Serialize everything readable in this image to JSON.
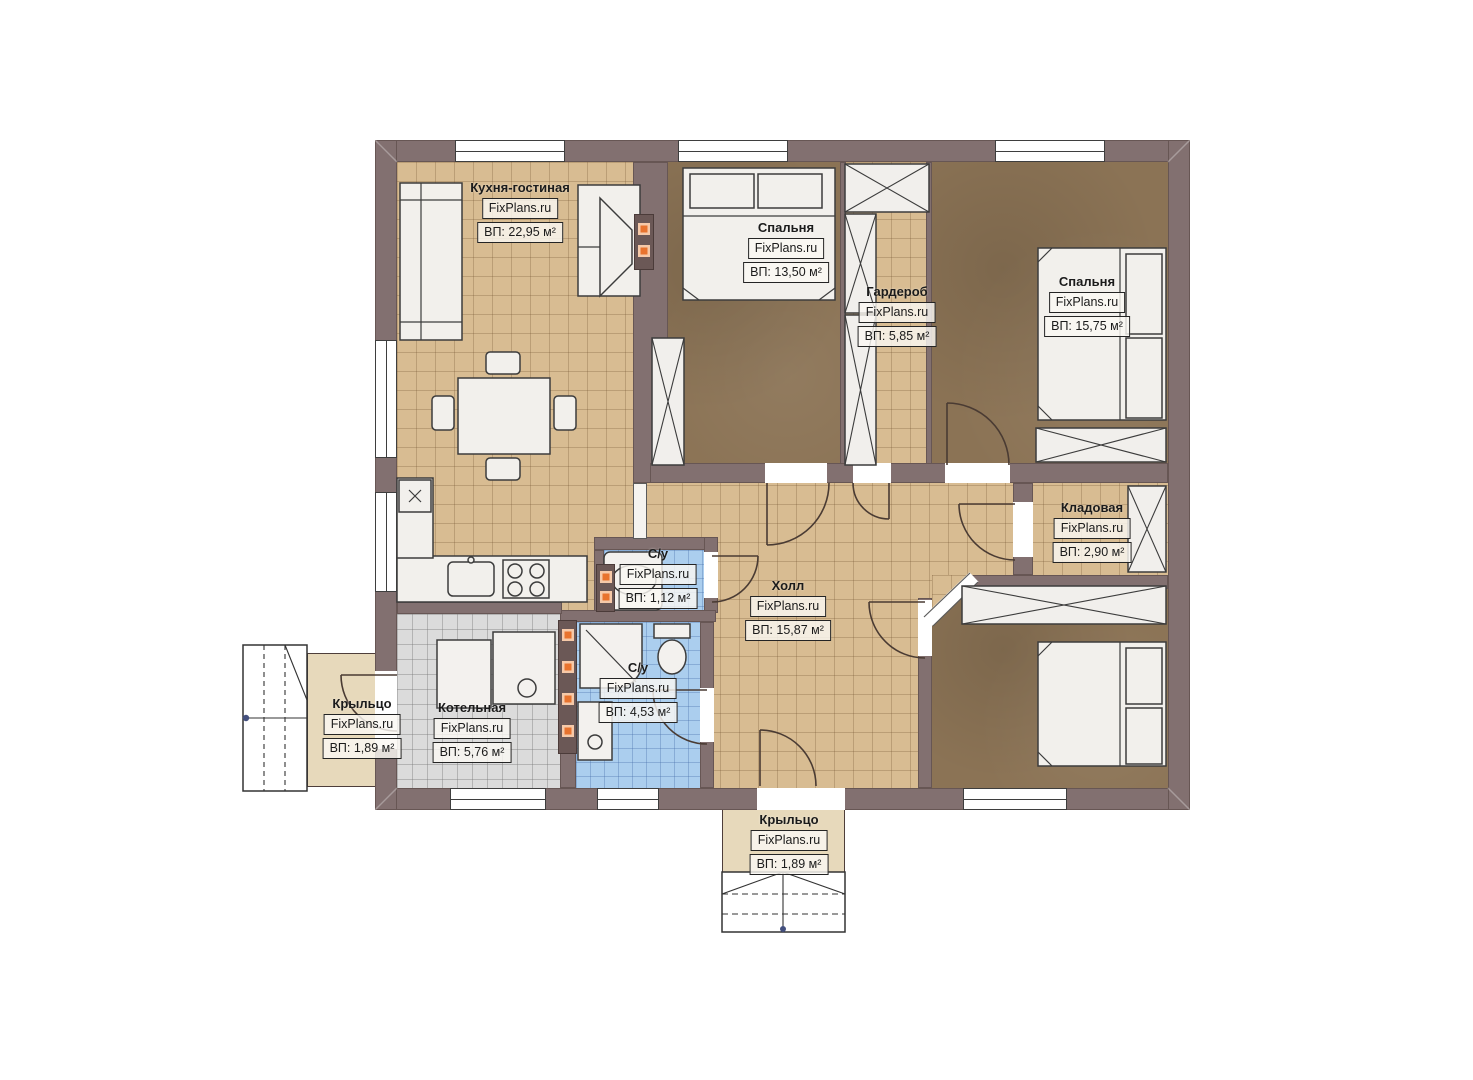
{
  "plan": {
    "title": "Floor plan of a single-storey house",
    "rooms": {
      "kitchen": {
        "name": "Кухня-гостиная",
        "brand": "FixPlans.ru",
        "area": "ВП: 22,95 м²"
      },
      "bedroom1": {
        "name": "Спальня",
        "brand": "FixPlans.ru",
        "area": "ВП: 13,50 м²"
      },
      "wardrobe": {
        "name": "Гардероб",
        "brand": "FixPlans.ru",
        "area": "ВП: 5,85 м²"
      },
      "bedroom2": {
        "name": "Спальня",
        "brand": "FixPlans.ru",
        "area": "ВП: 15,75 м²"
      },
      "storage": {
        "name": "Кладовая",
        "brand": "FixPlans.ru",
        "area": "ВП: 2,90 м²"
      },
      "hall": {
        "name": "Холл",
        "brand": "FixPlans.ru",
        "area": "ВП: 15,87 м²"
      },
      "bathroom_small": {
        "name": "С/у",
        "brand": "FixPlans.ru",
        "area": "ВП: 1,12 м²"
      },
      "bathroom_large": {
        "name": "С/у",
        "brand": "FixPlans.ru",
        "area": "ВП: 4,53 м²"
      },
      "boiler": {
        "name": "Котельная",
        "brand": "FixPlans.ru",
        "area": "ВП: 5,76 м²"
      },
      "porch_left": {
        "name": "Крыльцо",
        "brand": "FixPlans.ru",
        "area": "ВП: 1,89 м²"
      },
      "porch_bottom": {
        "name": "Крыльцо",
        "brand": "FixPlans.ru",
        "area": "ВП: 1,89 м²"
      }
    },
    "colors": {
      "wall": "#827070",
      "tile_floor": "#d8bc92",
      "bedroom_floor": "#8b7355",
      "bathroom_floor": "#abceee",
      "boiler_floor": "#dbdbdb",
      "porch_floor": "#e7d9bb",
      "vent_accent": "#e8732e"
    }
  }
}
